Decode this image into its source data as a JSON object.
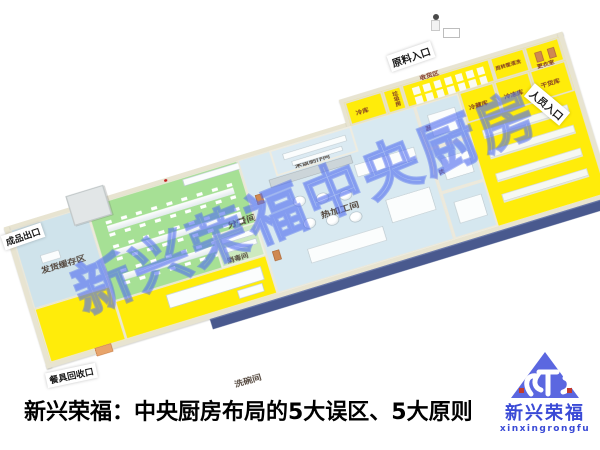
{
  "caption": {
    "text": "新兴荣福：中央厨房布局的5大误区、5大原则"
  },
  "watermark": {
    "text": "新兴荣福中央厨房",
    "color": "#5673f0"
  },
  "logo": {
    "cn": "新兴荣福",
    "latin": "xinxingrongfu",
    "color": "#3a4ad6"
  },
  "entrances": {
    "raw_material": "原料入口",
    "personnel": "人员入口",
    "finished_product": "成品出口",
    "tableware_return": "餐具回收口"
  },
  "rooms": {
    "shipping_buffer": "发货缓存区",
    "portioning": "分餐间",
    "dishwashing": "洗碗间",
    "disinfection": "消毒间",
    "second_change": "二次更衣",
    "hot_processing": "热加工间",
    "rice_making": "米饭制作间",
    "veg_rough": "蔬菜粗加工",
    "meat_rough": "肉类粗加工",
    "pastry": "面点间",
    "cold_storage": "冷藏库",
    "freezer": "冷冻库",
    "dry_goods": "干货库",
    "cold_store": "冷库",
    "garbage": "垃圾房",
    "receiving": "收货区",
    "basket_wash": "周转筐清洗",
    "changing": "更衣室"
  },
  "colors": {
    "floor_yellow": "#ffec0a",
    "floor_green": "#a6e095",
    "floor_blue": "#cfe3eb",
    "wall": "#e8e4d1",
    "dock_strip": "#49598e",
    "watermark_blue": "#5673f0",
    "logo_blue": "#3a4ad6"
  }
}
